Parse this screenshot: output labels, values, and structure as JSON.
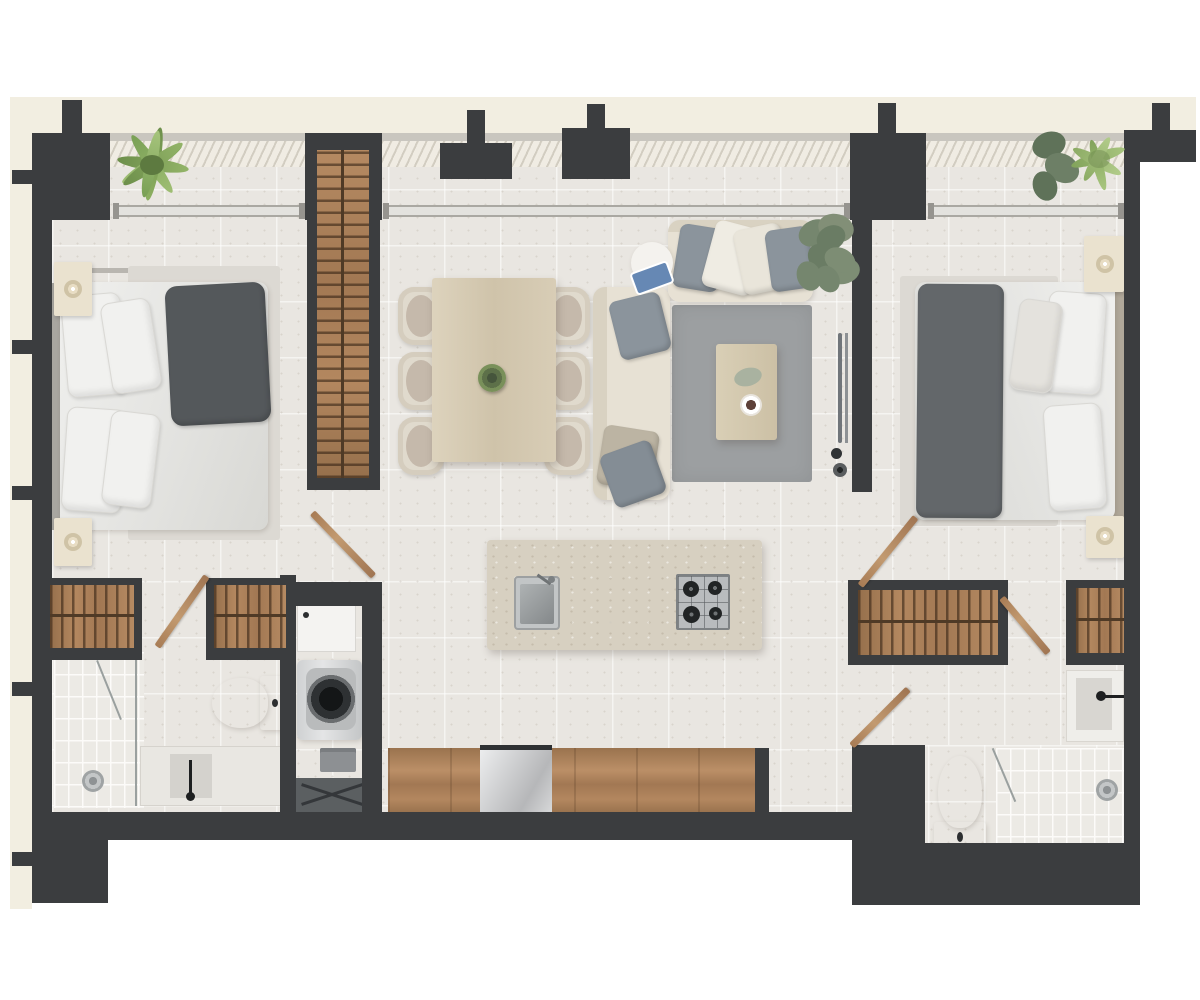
{
  "palette": {
    "page": "#ffffff",
    "outer_band": "#f2eee1",
    "wall": "#3b3d3f",
    "floor": "#e9e6e1",
    "hatch_bg": "#f0ece3",
    "hatch_line": "#d2cdc1",
    "window_frame": "#aaa8a2",
    "window_glass": "#e3e2de",
    "tile": "#eceae5",
    "tile_line": "#fcfbf9",
    "wood": "#a87c55",
    "wood_light": "#d8cdb6",
    "island_counter": "#d7d0c1",
    "sofa_fabric": "#e7e1d4",
    "rug_gray": "#9c9fa1",
    "bed_rug": "#dcd9d3",
    "linen_white": "#ededeb",
    "blanket_gray": "#54585b",
    "cushion_gray": "#8b949c",
    "fixture_white": "#f6f6f4",
    "steel": "#b9bcbe",
    "fern_green": "#83a45c",
    "monstera_green": "#75866e",
    "palm_green": "#9bb877"
  },
  "plan": {
    "type": "apartment-floor-plan",
    "rooms": [
      {
        "name": "bedroom-1",
        "furniture": [
          "double-bed",
          "two-nightstands",
          "candles",
          "bed-runner-rug",
          "curtain-rail"
        ]
      },
      {
        "name": "hall-wardrobe",
        "furniture": [
          "tall-wardrobe-with-hanging-rail"
        ]
      },
      {
        "name": "bathroom-1",
        "furniture": [
          "walk-in-closet-left",
          "walk-in-closet-right",
          "toilet",
          "vanity-with-sink",
          "walk-in-shower",
          "glass-screen",
          "door-leaf"
        ]
      },
      {
        "name": "laundry-utility",
        "furniture": [
          "utility-sink",
          "washing-machine",
          "detergent-box",
          "folding-rack"
        ]
      },
      {
        "name": "dining-area",
        "furniture": [
          "dining-table",
          "six-chairs",
          "plant-centerpiece"
        ]
      },
      {
        "name": "living-area",
        "furniture": [
          "l-shaped-sofa",
          "throw-pillows",
          "round-side-table",
          "books",
          "gray-rug",
          "coffee-table",
          "coffee-cup",
          "wall-tv",
          "monstera-plant"
        ]
      },
      {
        "name": "kitchen",
        "furniture": [
          "island-with-sink-and-hob",
          "base-cabinets",
          "tall-appliance"
        ]
      },
      {
        "name": "bedroom-2",
        "furniture": [
          "double-bed",
          "two-nightstands",
          "candles",
          "bed-rug",
          "plants",
          "door-leaf"
        ]
      },
      {
        "name": "bathroom-2",
        "furniture": [
          "walk-in-closet-left",
          "walk-in-closet-right",
          "vanity-with-sink",
          "toilet",
          "walk-in-shower",
          "glass-screen",
          "wood-bench",
          "door-leaf"
        ]
      },
      {
        "name": "balcony-band",
        "furniture": [
          "deck-hatching",
          "fern-plant",
          "palm-plant"
        ]
      }
    ],
    "window_segments": 3,
    "wall_pier_count": 6
  }
}
